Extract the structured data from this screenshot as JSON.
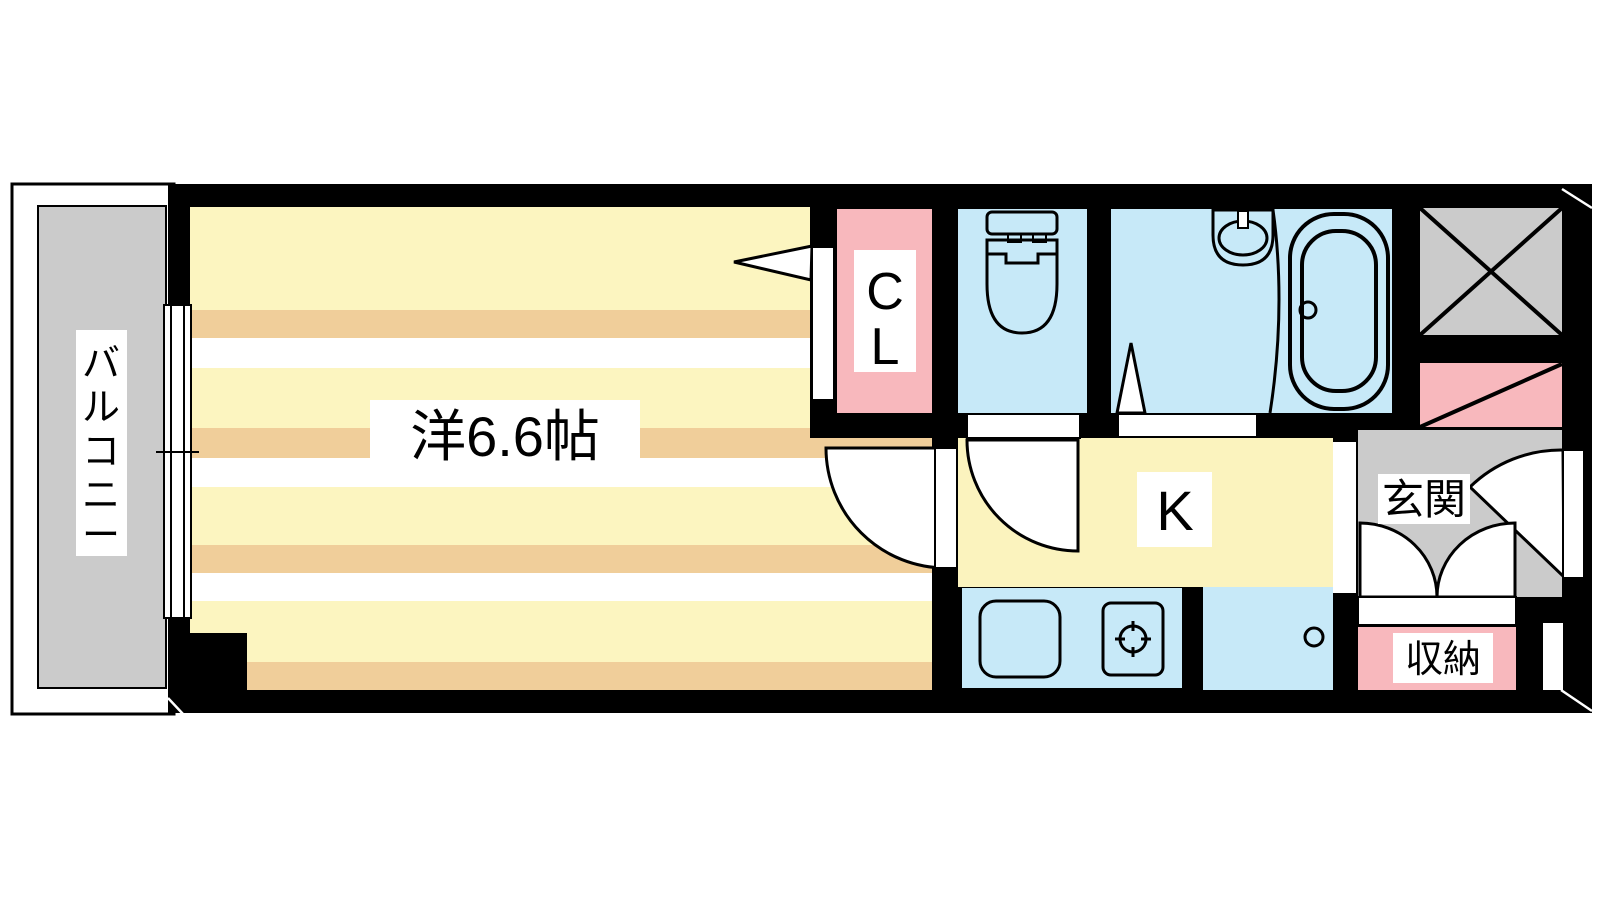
{
  "floorplan": {
    "balcony": {
      "label": "バルコニー",
      "chars": [
        "バ",
        "ル",
        "コ",
        "ニ",
        "ー"
      ]
    },
    "western_room": {
      "label": "洋6.6帖"
    },
    "closet": {
      "label": "CL",
      "chars": [
        "C",
        "L"
      ]
    },
    "kitchen": {
      "label": "K"
    },
    "entrance": {
      "label": "玄関"
    },
    "storage": {
      "label": "収納"
    },
    "colors": {
      "wall_black": "#000000",
      "tatami_yellow": "#FCF5C0",
      "tatami_tan": "#F0CE9A",
      "stripe_white": "#FFFFFF",
      "kitchen_yellow": "#FBF3BE",
      "water_blue": "#C7E9F8",
      "closet_pink": "#F8B8BD",
      "balcony_gray": "#CBCBCB",
      "label_box": "#FFFFFF"
    },
    "icons": {
      "toilet": "toilet-icon",
      "washbasin": "washbasin-icon",
      "bathtub": "bathtub-icon",
      "kitchen_sink": "kitchen-sink-icon",
      "stove": "stove-icon",
      "sliding_window": "sliding-window-icon",
      "door_swing": "door-swing-icon",
      "shaft_cross": "x-shaft-icon"
    }
  }
}
